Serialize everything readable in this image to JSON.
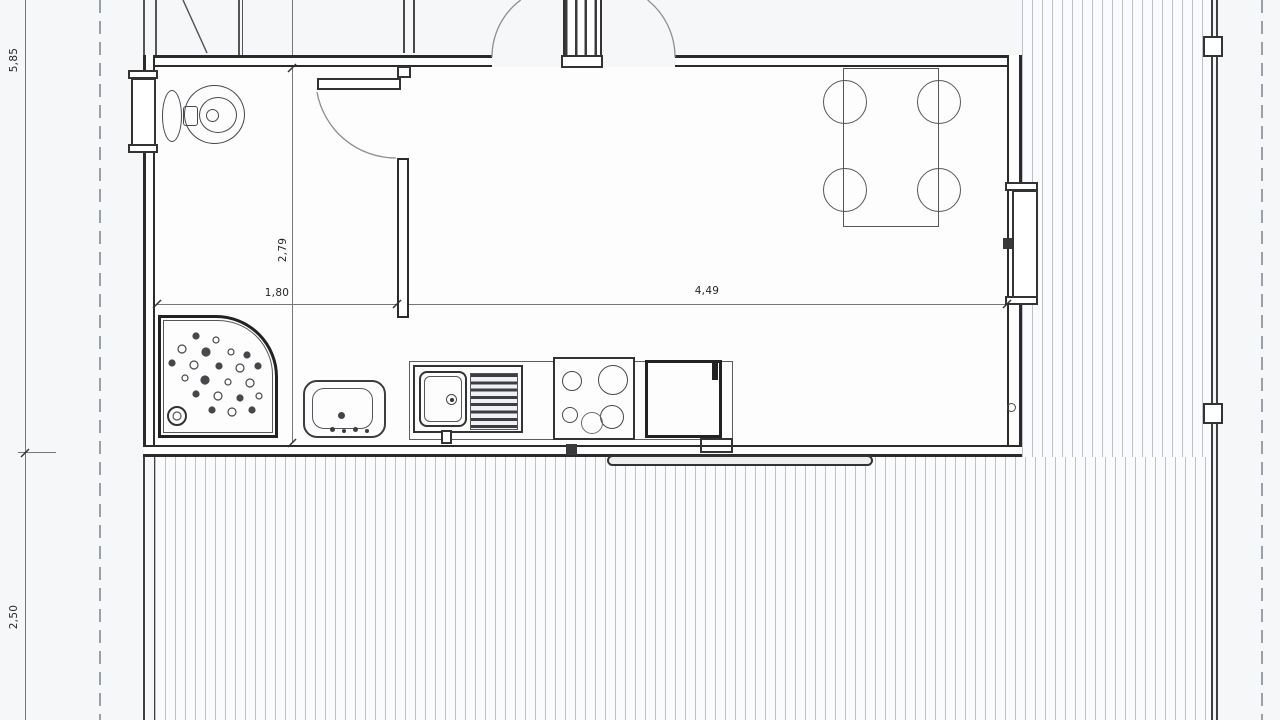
{
  "plan": {
    "dimension_labels": {
      "left_upper": "5,85",
      "left_lower": "2,50",
      "bath_depth": "2,79",
      "bath_width": "1,80",
      "living_width": "4,49"
    },
    "colors": {
      "paper": "#f6f7f9",
      "interior": "#fdfdfe",
      "wall_line": "#2b2b2b",
      "deck_stripe": "#8c939e",
      "dashed_line": "#9aa0a8",
      "dimension_line": "#777777"
    },
    "fixtures": [
      "toilet",
      "shower",
      "washbasin",
      "kitchen-sink",
      "cooktop",
      "refrigerator",
      "dining-table",
      "chairs",
      "entry-double-door",
      "bathroom-door",
      "left-window",
      "right-window",
      "terrace-deck",
      "sliding-threshold"
    ]
  }
}
